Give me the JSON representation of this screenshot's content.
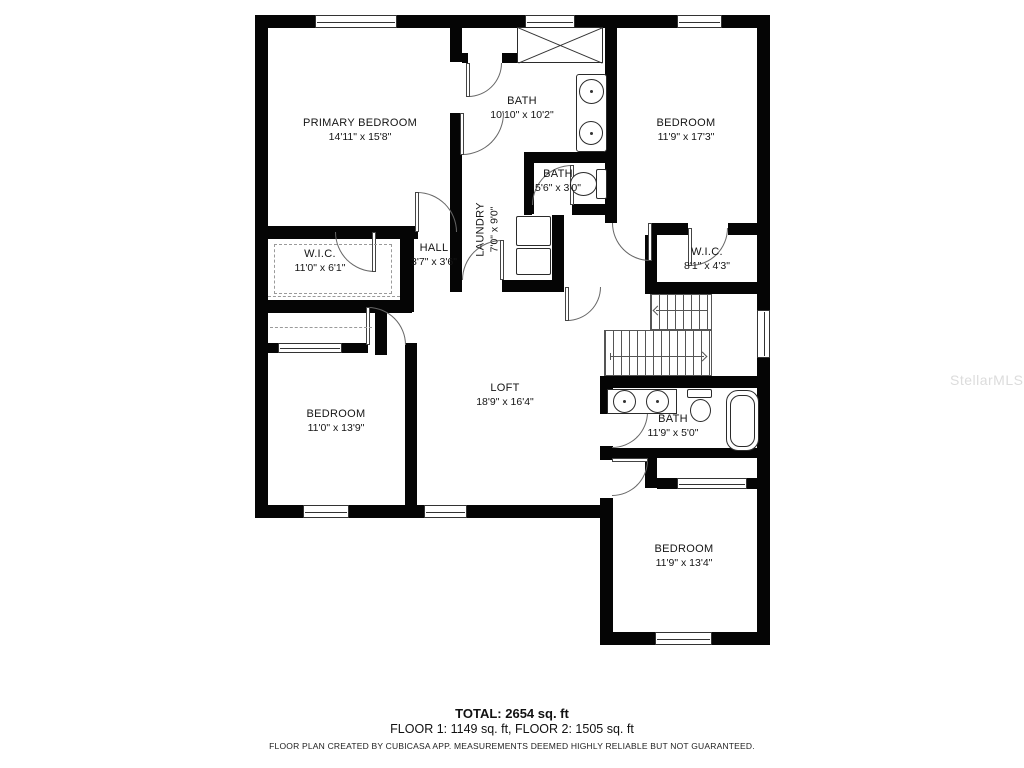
{
  "watermark": "StellarMLS",
  "rooms": [
    {
      "name": "PRIMARY BEDROOM",
      "dims": "14'11\" x 15'8\""
    },
    {
      "name": "BATH",
      "dims": "10'10\" x 10'2\""
    },
    {
      "name": "BEDROOM",
      "dims": "11'9\" x 17'3\""
    },
    {
      "name": "BATH",
      "dims": "5'6\" x 3'0\""
    },
    {
      "name": "LAUNDRY",
      "dims": "7'0\" x 9'0\""
    },
    {
      "name": "W.I.C.",
      "dims": "11'0\" x 6'1\""
    },
    {
      "name": "HALL",
      "dims": "3'7\" x 3'6\""
    },
    {
      "name": "W.I.C.",
      "dims": "8'1\" x 4'3\""
    },
    {
      "name": "LOFT",
      "dims": "18'9\" x 16'4\""
    },
    {
      "name": "BEDROOM",
      "dims": "11'0\" x 13'9\""
    },
    {
      "name": "BATH",
      "dims": "11'9\" x 5'0\""
    },
    {
      "name": "BEDROOM",
      "dims": "11'9\" x 13'4\""
    }
  ],
  "footer": {
    "total": "TOTAL: 2654 sq. ft",
    "floors": "FLOOR 1: 1149 sq. ft, FLOOR 2: 1505 sq. ft",
    "disclaimer": "FLOOR PLAN CREATED BY CUBICASA APP. MEASUREMENTS DEEMED HIGHLY RELIABLE BUT NOT GUARANTEED."
  }
}
